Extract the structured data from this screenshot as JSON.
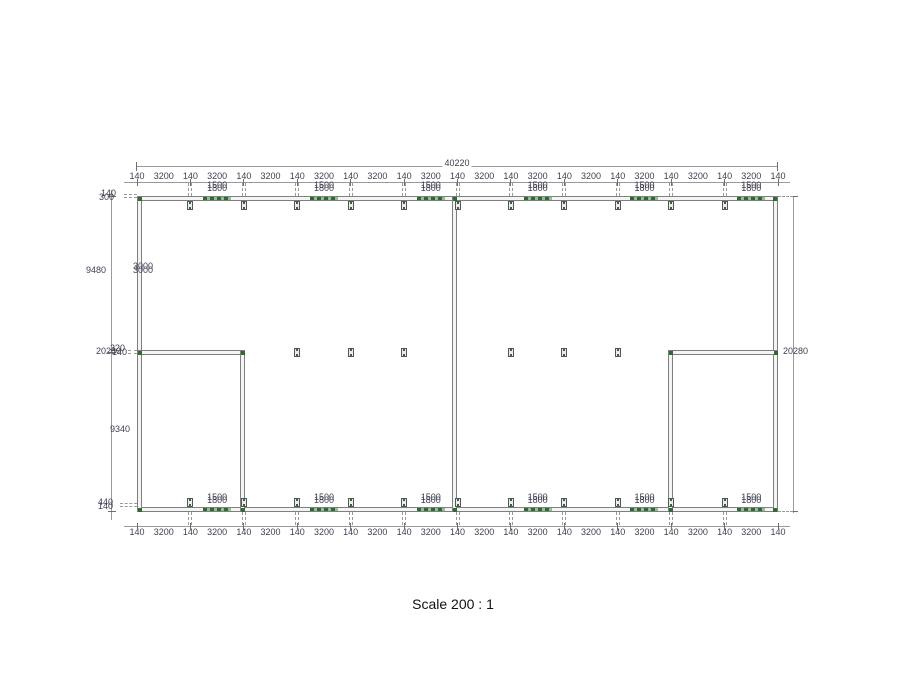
{
  "drawing": {
    "type": "floor-plan",
    "scale_label": "Scale 200 : 1"
  },
  "colors": {
    "wall_line": "#7f7f7f",
    "wall_fill": "#f4f4f4",
    "window_green": "#2e6b34",
    "window_green_light": "#94bd91",
    "dim_text": "#3e3e52",
    "dim_line": "#9a9a9a",
    "scale_text": "#111111"
  },
  "dimensions": {
    "overall_width": "40220",
    "overall_height_right": "20280",
    "top_chain": [
      "140",
      "3200",
      "140",
      "3200",
      "140",
      "3200",
      "140",
      "3200",
      "140",
      "3200",
      "140",
      "3200",
      "140",
      "3200",
      "140",
      "3200",
      "140",
      "3200",
      "140",
      "3200",
      "140",
      "3200",
      "140",
      "3200",
      "140"
    ],
    "bottom_chain": [
      "140",
      "3200",
      "140",
      "3200",
      "140",
      "3200",
      "140",
      "3200",
      "140",
      "3200",
      "140",
      "3200",
      "140",
      "3200",
      "140",
      "3200",
      "140",
      "3200",
      "140",
      "3200",
      "140",
      "3200",
      "140",
      "3200",
      "140"
    ],
    "left_labels": [
      {
        "text": "140",
        "x": 101,
        "y": 189
      },
      {
        "text": "300",
        "x": 99,
        "y": 193
      },
      {
        "text": "9480",
        "x": 86,
        "y": 266
      },
      {
        "text": "3000",
        "x": 133,
        "y": 262
      },
      {
        "text": "3000",
        "x": 133,
        "y": 266
      },
      {
        "text": "20280",
        "x": 96,
        "y": 347
      },
      {
        "text": "320",
        "x": 110,
        "y": 344
      },
      {
        "text": "140",
        "x": 112,
        "y": 348
      },
      {
        "text": "9340",
        "x": 110,
        "y": 425
      },
      {
        "text": "440",
        "x": 98,
        "y": 498
      },
      {
        "text": "140",
        "x": 98,
        "y": 502
      }
    ]
  },
  "windows": {
    "top": {
      "bays": [
        2,
        4,
        6,
        8,
        10,
        12
      ],
      "labels": [
        "1500",
        "1800"
      ],
      "width_mm": "1800"
    },
    "bottom": {
      "bays": [
        2,
        4,
        6,
        8,
        10,
        12
      ],
      "labels": [
        "1500",
        "1800"
      ],
      "width_mm": "1500"
    }
  },
  "structure": {
    "posts_top_bays": [
      1,
      2,
      3,
      4,
      5,
      6,
      7,
      8,
      9,
      10,
      11
    ],
    "posts_bottom_bays": [
      1,
      2,
      3,
      4,
      5,
      6,
      7,
      8,
      9,
      10,
      11
    ],
    "posts_mid_bays": [
      3,
      4,
      5,
      7,
      8,
      9
    ]
  }
}
